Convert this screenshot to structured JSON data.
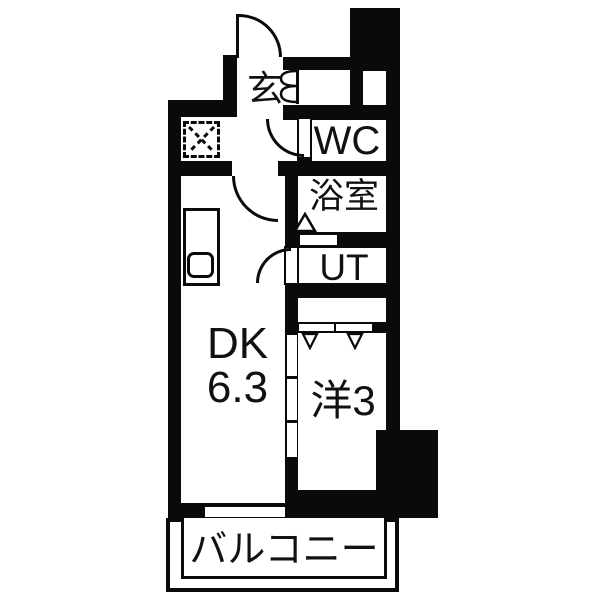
{
  "plan": {
    "type": "apartment-floor-plan",
    "rooms": {
      "entrance": {
        "label": "玄"
      },
      "wc": {
        "label": "WC"
      },
      "bathroom": {
        "label": "浴室"
      },
      "utility": {
        "label": "UT"
      },
      "dining_kitchen": {
        "label": "DK",
        "size": "6.3"
      },
      "western_room": {
        "label": "洋3"
      },
      "balcony": {
        "label": "バルコニー"
      }
    },
    "colors": {
      "wall": "#0a0a0a",
      "floor": "#ffffff",
      "text": "#111111"
    },
    "symbols": {
      "entrance_door": "hinged-door-arc",
      "wc_door": "hinged-door-arc",
      "dk_door": "hinged-door-arc",
      "ut_door": "hinged-door-arc",
      "bathroom_door": "fold-door-triangle",
      "washing_machine_space": "dashed-square-with-x",
      "kitchen": "counter-with-sink",
      "shoe_cabinet": "scalloped-door",
      "closet": "hanger-marks",
      "dk_partition": "three-panel-sliding-door",
      "balcony_window": "sash-window"
    }
  }
}
